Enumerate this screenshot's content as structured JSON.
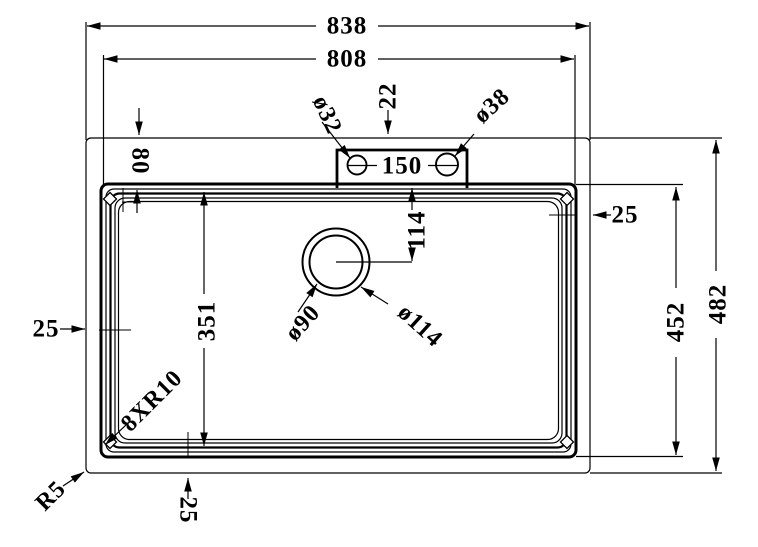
{
  "page": {
    "background_color": "#ffffff",
    "line_color": "#000000",
    "description": "Technical dimension drawing, kitchen sink top view"
  },
  "drawing_labels": {
    "dim_overall_width": "838",
    "dim_inner_width": "808",
    "dim_overall_height": "482",
    "dim_inner_height": "452",
    "dim_ledge_depth": "80",
    "dim_deck_offset": "22",
    "dim_hole_left_diameter": "ø32",
    "dim_hole_right_diameter": "ø38",
    "dim_hole_spacing": "150",
    "dim_rim_right": "25",
    "dim_rim_left": "25",
    "dim_rim_bottom": "25",
    "dim_drain_offset_from_top": "114",
    "dim_bowl_length": "351",
    "dim_drain_inner_diameter": "ø90",
    "dim_drain_outer_diameter": "ø114",
    "dim_bowl_corner_radius": "8XR10",
    "dim_outer_corner_radius": "R5"
  }
}
